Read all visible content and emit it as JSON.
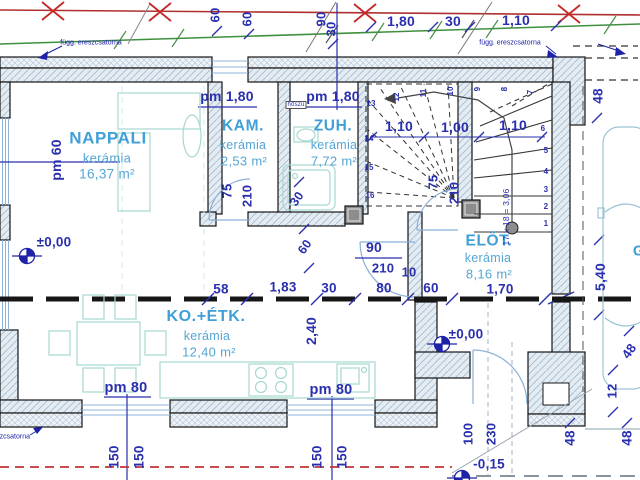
{
  "rooms": {
    "nappali": {
      "name": "NAPPALI",
      "material": "kerámia",
      "area": "16,37 m²"
    },
    "kam": {
      "name": "KAM.",
      "material": "kerámia",
      "area": "2,53 m²"
    },
    "zuh": {
      "name": "ZUH.",
      "material": "kerámia",
      "area": "7,72 m²"
    },
    "elot": {
      "name": "ELŐT.",
      "material": "kerámia",
      "area": "8,16 m²"
    },
    "koetk": {
      "name": "KO.+ÉTK.",
      "material": "kerámia",
      "area": "12,40 m²"
    },
    "garage": {
      "name": "G"
    }
  },
  "levels": {
    "nappali": "±0,00",
    "elot": "±0,00",
    "entry": "-0,15"
  },
  "parapets": {
    "west": "pm 60",
    "kam": "pm 1,80",
    "zuh": "pm 1,80",
    "south_left": "pm 80",
    "south_mid": "pm 80"
  },
  "annotations": {
    "gutter_left": "függ. ereszcsatorna",
    "gutter_right": "függ. ereszcsatorna",
    "gutter_bottom": "ereszcsatorna",
    "insulation": "hőszü",
    "stair_formula": "17 x 18 = 3,06"
  },
  "dims": {
    "top": {
      "v60a": "60",
      "v60b": "60",
      "v90": "90",
      "v30s": "30",
      "w180": "1,80",
      "w30": "30",
      "w110": "1,10"
    },
    "stair": {
      "a": "1,10",
      "b": "1,00",
      "c": "1,10"
    },
    "chain": {
      "a": "58",
      "b": "1,83",
      "c": "30",
      "d": "80",
      "e": "60",
      "f": "1,70"
    },
    "mid": {
      "d30": "30",
      "d60": "60",
      "v240": "2,40"
    },
    "right": {
      "v48a": "48",
      "v540": "5,40",
      "v12": "12",
      "v48b": "48",
      "v48c": "48",
      "v48d": "48"
    },
    "south": {
      "a": "150",
      "b": "150",
      "c": "150",
      "d": "150"
    }
  },
  "doors": {
    "kam": {
      "w": "75",
      "h": "210"
    },
    "elot": {
      "w": "75",
      "h": "210"
    },
    "main": {
      "w": "90",
      "h": "210",
      "off": "10"
    },
    "entry": {
      "w": "100",
      "h": "230"
    }
  },
  "stairs": {
    "numbers": [
      "1",
      "2",
      "3",
      "4",
      "5",
      "6",
      "7",
      "8",
      "9",
      "10",
      "11",
      "12",
      "13",
      "14",
      "15",
      "16"
    ]
  },
  "colors": {
    "dim_blue": "#2a2fae",
    "room_label": "#3f9fd6",
    "roof_red": "#c62828",
    "roof_green": "#3f8f3f",
    "wall_line": "#141414",
    "furniture": "#a6d8d0"
  }
}
